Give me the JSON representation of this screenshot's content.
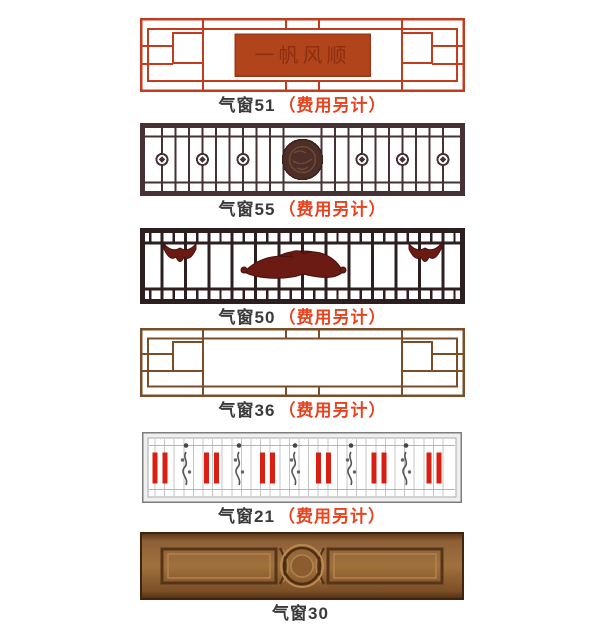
{
  "page": {
    "background": "#ffffff",
    "description": "catalog of transom window styles"
  },
  "items": [
    {
      "name": "气窗51",
      "note": "（费用另计）",
      "style": "red-lattice-with-plaque",
      "plaque_text": "一帆风顺"
    },
    {
      "name": "气窗55",
      "note": "（费用另计）",
      "style": "dark-grid-with-medallions"
    },
    {
      "name": "气窗50",
      "note": "（费用另计）",
      "style": "dark-grid-with-carving"
    },
    {
      "name": "气窗36",
      "note": "（费用另计）",
      "style": "brown-lattice-empty-center"
    },
    {
      "name": "气窗21",
      "note": "（费用另计）",
      "style": "white-grid-red-bars"
    },
    {
      "name": "气窗30",
      "note": "",
      "style": "solid-wood-panel"
    }
  ],
  "colors": {
    "lattice_red": "#c43c1e",
    "plaque_orange": "#b2441c",
    "plaque_text_red": "#7d260c",
    "dark_grid_brown": "#463134",
    "medallion_brown": "#4e2f28",
    "carving_maroon": "#6b1b14",
    "dark_grid3": "#2d1f1f",
    "lattice_brown": "#7a4e28",
    "grid_gray": "#c2c2c2",
    "bar_red": "#d91f12",
    "wood_brown": "#a0713d",
    "label_text": "#3a3a3a",
    "label_note_red": "#e8431f"
  }
}
